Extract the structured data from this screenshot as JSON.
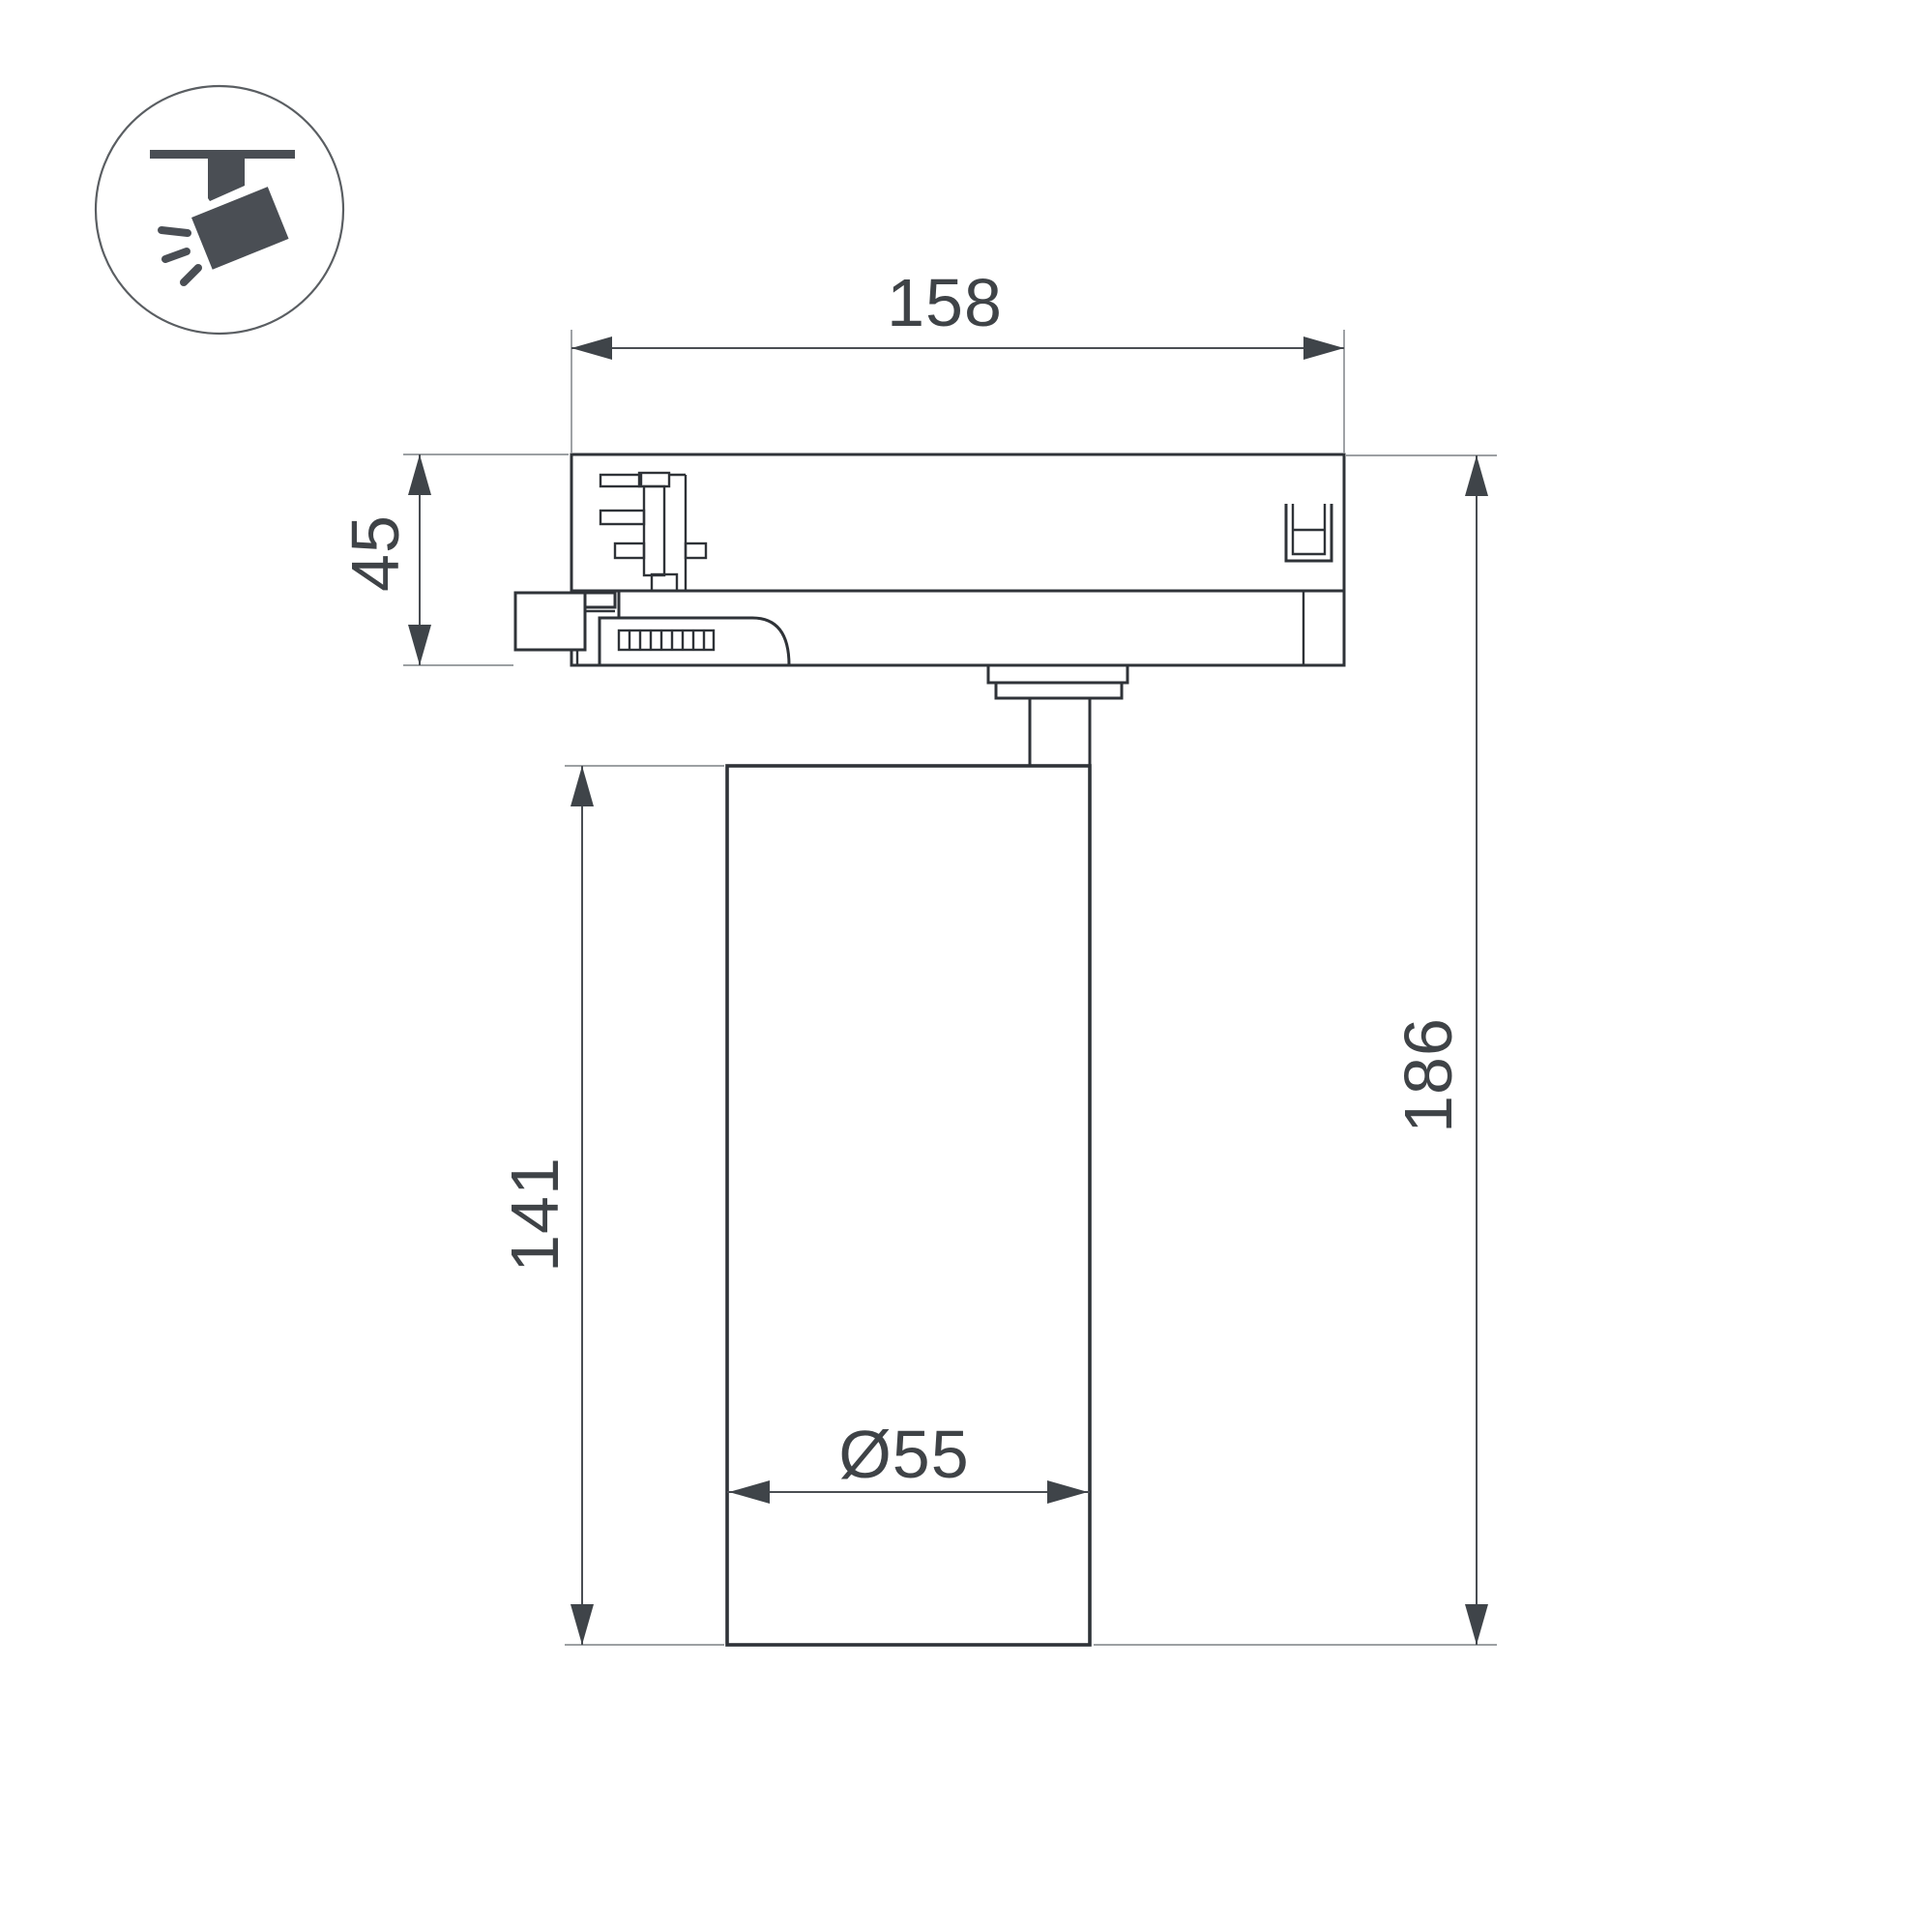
{
  "drawing": {
    "type": "technical-dimension-drawing",
    "subject": "track-mounted spotlight, side elevation",
    "background_color": "#ffffff",
    "outline_color": "#2f3338",
    "dimension_color": "#4a4e53",
    "extension_color": "#8e9296",
    "text_color": "#3f4347",
    "icon": {
      "name": "track-spotlight-icon",
      "color": "#4a4e54"
    },
    "dimensions": {
      "track_adapter_width": "158",
      "track_adapter_height": "45",
      "lamp_body_height": "141",
      "total_height": "186",
      "lamp_body_diameter": "Ø55"
    }
  }
}
